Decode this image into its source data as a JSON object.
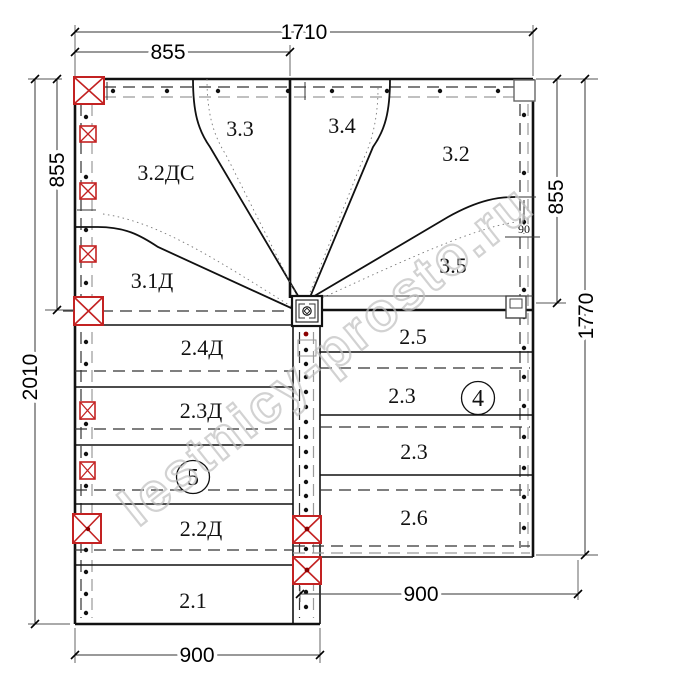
{
  "watermark": "lestnicy-prosto.ru",
  "dimensions": {
    "top_total": "1710",
    "top_left_half": "855",
    "left_upper": "855",
    "left_total": "2010",
    "right_upper": "855",
    "right_total": "1770",
    "bottom_left_width": "900",
    "bottom_right_width": "900",
    "stringer_gap": "90"
  },
  "winder_labels": {
    "l3_3": "3.3",
    "l3_4": "3.4",
    "l3_2dc": "3.2ДС",
    "l3_2": "3.2",
    "l3_1d": "3.1Д",
    "l3_5": "3.5"
  },
  "left_flight": {
    "s2_4d": "2.4Д",
    "s2_3d": "2.3Д",
    "s2_2d": "2.2Д",
    "s2_1": "2.1",
    "flight_number": "5"
  },
  "right_flight": {
    "s2_5": "2.5",
    "s2_3a": "2.3",
    "s2_3b": "2.3",
    "s2_6": "2.6",
    "flight_number": "4"
  }
}
